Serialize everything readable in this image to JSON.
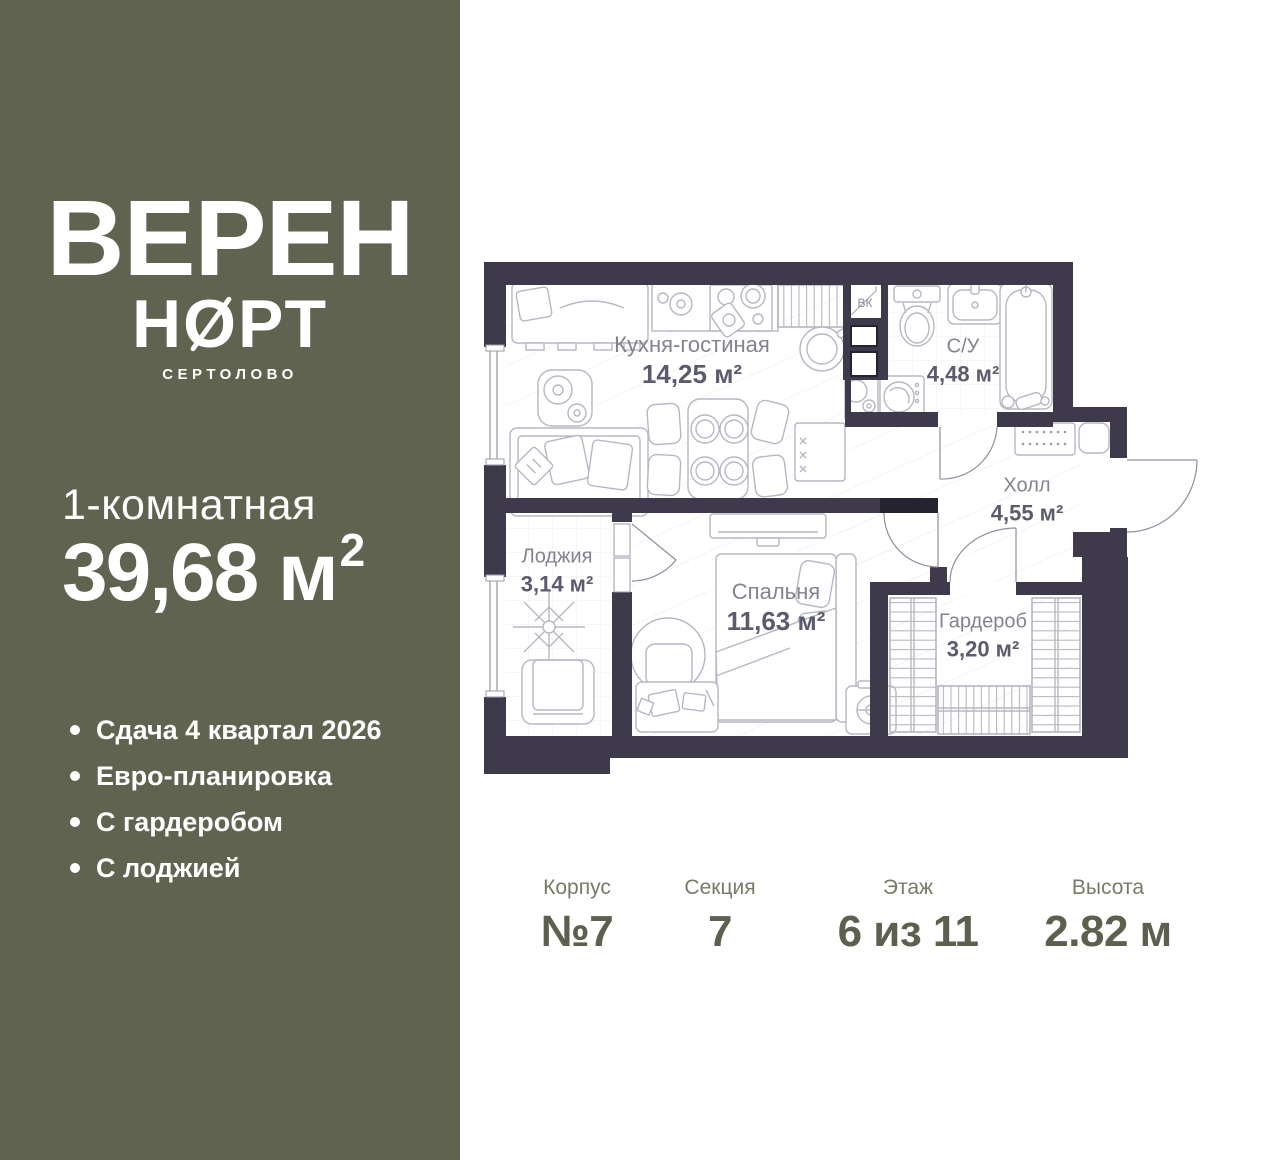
{
  "brand": {
    "line1": "ВЕРЕН",
    "line2_prefix": "Н",
    "line2_slashed_letter": "О",
    "line2_suffix": "РТ",
    "city": "СЕРТОЛОВО"
  },
  "listing": {
    "rooms_type": "1-комнатная",
    "area_value": "39,68",
    "area_unit": " м",
    "area_superscript": "2"
  },
  "features": [
    "Сдача 4 квартал 2026",
    "Евро-планировка",
    "С гардеробом",
    "С лоджией"
  ],
  "plan": {
    "rooms": {
      "kitchen": {
        "name": "Кухня-гостиная",
        "area": "14,25 м²"
      },
      "bathroom": {
        "name": "С/У",
        "area": "4,48 м²"
      },
      "hall": {
        "name": "Холл",
        "area": "4,55 м²"
      },
      "loggia": {
        "name": "Лоджия",
        "area": "3,14 м²"
      },
      "bedroom": {
        "name": "Спальня",
        "area": "11,63 м²"
      },
      "wardrobe": {
        "name": "Гардероб",
        "area": "3,20 м²"
      }
    },
    "vk_label": "ВК"
  },
  "stats": [
    {
      "label": "Корпус",
      "value": "№7"
    },
    {
      "label": "Секция",
      "value": "7"
    },
    {
      "label": "Этаж",
      "value": "6 из 11"
    },
    {
      "label": "Высота",
      "value": "2.82 м"
    }
  ],
  "colors": {
    "sidebar_bg": "#5f634f",
    "wall": "#3e3a4b",
    "wall_dark": "#262331",
    "furniture_line": "#b7b7c3",
    "room_text": "#83838f",
    "stat_text": "#5c604e"
  }
}
